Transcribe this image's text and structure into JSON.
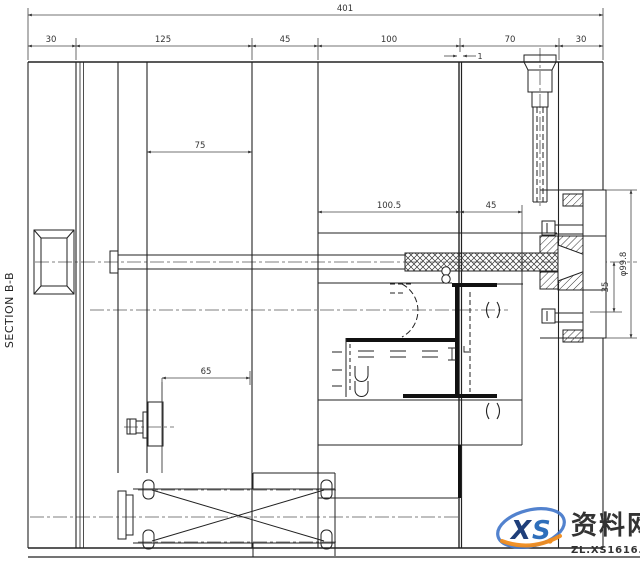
{
  "section": {
    "label": "SECTION B-B"
  },
  "dims": {
    "overall": "401",
    "row": [
      "30",
      "125",
      "45",
      "100",
      "70",
      "30"
    ],
    "gap": "1",
    "ejector_span": "75",
    "core_len": "100.5",
    "insert_len": "45",
    "stop_offset": "65",
    "ring_offset": "35",
    "ring_dia": "φ99.8"
  },
  "watermark": {
    "logo_x": "X",
    "logo_s": "S",
    "name": "资料网",
    "url": "ZL.XS1616.COM"
  },
  "colors": {
    "line": "#2b2b2b",
    "dim_line": "#444444",
    "watermark_red": "#d5342b",
    "watermark_blue": "#2e6fbb",
    "watermark_dark_blue": "#1f3f7a",
    "watermark_orange": "#f08c1e",
    "url_gray": "#8f979e"
  }
}
